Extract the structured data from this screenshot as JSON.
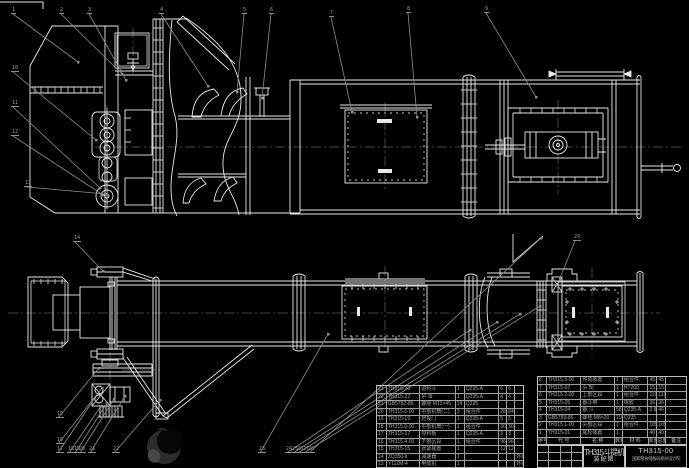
{
  "app": {
    "background": "#000000",
    "kind": "cad-assembly-drawing"
  },
  "colors": {
    "line": "#e9e9e9",
    "thin_line": "#c9c9c9",
    "leader": "#8d8d8d",
    "centerline": "#585858",
    "table_line": "#9f9f9f",
    "table_text": "#a9a9a9",
    "logo_body": "#2c2c2c",
    "logo_hole": "#060606",
    "logo_glow": "#474747"
  },
  "title_block": {
    "product": "TH315斗提机",
    "sheet": "装配图",
    "drawing_no": "TH315-00",
    "company": "国家粮食储备局郑州设计院"
  },
  "bom": {
    "header": [
      "序号",
      "代 号",
      "名 称",
      "数量",
      "材 料",
      "单重",
      "总重",
      "备注"
    ],
    "left_rows": [
      [
        "23",
        "TH315-23",
        "进料斗",
        "1",
        "Q235-A",
        "6",
        "6",
        ""
      ],
      [
        "22",
        "TH315-22",
        "护 罩",
        "1",
        "Q235-A",
        "4",
        "4",
        ""
      ],
      [
        "21",
        "GB5782-86",
        "螺栓 M12×45",
        "24",
        "Q235",
        "",
        "",
        ""
      ],
      [
        "20",
        "TH315.6-00",
        "中部机筒(二)",
        "3",
        "组合件",
        "28",
        "84",
        ""
      ],
      [
        "19",
        "TH315-19",
        "检视门",
        "1",
        "Q235-A",
        "5",
        "5",
        ""
      ],
      [
        "18",
        "TH315.5-00",
        "中部机筒(一)",
        "1",
        "组合件",
        "30",
        "30",
        ""
      ],
      [
        "17",
        "TH315-17",
        "导料板",
        "1",
        "Q235-A",
        "3",
        "3",
        ""
      ],
      [
        "16",
        "TH315.4-00",
        "下部区段",
        "1",
        "组合件",
        "96",
        "96",
        ""
      ],
      [
        "15",
        "TH315-15",
        "张紧装置",
        "1",
        "",
        "12",
        "12",
        ""
      ],
      [
        "14",
        "ZQ350-Ⅱ",
        "减速器",
        "1",
        "",
        "",
        "",
        "外购"
      ],
      [
        "13",
        "Y112M-4",
        "电动机",
        "1",
        "",
        "",
        "",
        "外购"
      ]
    ],
    "right_rows": [
      [
        "8",
        "TH315.3-00",
        "传动装置",
        "1",
        "组合件",
        "45",
        "45",
        ""
      ],
      [
        "7",
        "TH315-07",
        "头 轮",
        "1",
        "HT200",
        "15",
        "15",
        ""
      ],
      [
        "6",
        "TH315.2-00",
        "上部区段",
        "1",
        "组合件",
        "110",
        "110",
        ""
      ],
      [
        "5",
        "TH315-05",
        "畚斗带",
        "1",
        "橡胶",
        "36",
        "36",
        ""
      ],
      [
        "4",
        "TH315-04",
        "畚 斗",
        "58",
        "Q235-A",
        "0.8",
        "46",
        ""
      ],
      [
        "3",
        "GB5783-86",
        "螺栓 M8×20",
        "116",
        "Q235",
        "",
        "",
        ""
      ],
      [
        "2",
        "TH315.1-00",
        "头部区段",
        "1",
        "组合件",
        "105",
        "105",
        ""
      ],
      [
        "1",
        "TH315-01",
        "尾轮装置",
        "1",
        "",
        "40",
        "40",
        ""
      ]
    ]
  },
  "balloons": [
    {
      "n": "1",
      "x": 11,
      "y": 8,
      "tx": 78,
      "ty": 62
    },
    {
      "n": "2",
      "x": 59,
      "y": 8,
      "tx": 122,
      "ty": 74
    },
    {
      "n": "3",
      "x": 87,
      "y": 8,
      "tx": 126,
      "ty": 80
    },
    {
      "n": "4",
      "x": 159,
      "y": 8,
      "tx": 208,
      "ty": 86
    },
    {
      "n": "5",
      "x": 242,
      "y": 8,
      "tx": 237,
      "ty": 92
    },
    {
      "n": "6",
      "x": 269,
      "y": 8,
      "tx": 262,
      "ty": 98
    },
    {
      "n": "7",
      "x": 329,
      "y": 11,
      "tx": 352,
      "ty": 112
    },
    {
      "n": "8",
      "x": 406,
      "y": 7,
      "tx": 417,
      "ty": 117
    },
    {
      "n": "9",
      "x": 484,
      "y": 7,
      "tx": 536,
      "ty": 97
    },
    {
      "n": "10",
      "x": 11,
      "y": 66,
      "tx": 96,
      "ty": 140
    },
    {
      "n": "11",
      "x": 11,
      "y": 101,
      "tx": 100,
      "ty": 188
    },
    {
      "n": "12",
      "x": 11,
      "y": 130,
      "tx": 103,
      "ty": 195
    },
    {
      "n": "13",
      "x": 24,
      "y": 181,
      "tx": 106,
      "ty": 194
    },
    {
      "n": "14",
      "x": 73,
      "y": 236,
      "tx": 103,
      "ty": 271
    },
    {
      "n": "15",
      "x": 56,
      "y": 412,
      "tx": 99,
      "ty": 368
    },
    {
      "n": "16",
      "x": 56,
      "y": 438,
      "tx": 102,
      "ty": 388
    },
    {
      "n": "17",
      "x": 56,
      "y": 447,
      "tx": 94,
      "ty": 399
    },
    {
      "n": "18",
      "x": 67,
      "y": 447,
      "tx": 101,
      "ty": 406
    },
    {
      "n": "19",
      "x": 73,
      "y": 447,
      "tx": 107,
      "ty": 403
    },
    {
      "n": "20",
      "x": 78,
      "y": 447,
      "tx": 114,
      "ty": 399
    },
    {
      "n": "21",
      "x": 88,
      "y": 447,
      "tx": 125,
      "ty": 396
    },
    {
      "n": "22",
      "x": 112,
      "y": 447,
      "tx": 160,
      "ty": 400
    },
    {
      "n": "23",
      "x": 258,
      "y": 447,
      "tx": 328,
      "ty": 334
    },
    {
      "n": "24",
      "x": 285,
      "y": 447,
      "tx": 470,
      "ty": 330
    },
    {
      "n": "25",
      "x": 291,
      "y": 447,
      "tx": 497,
      "ty": 322
    },
    {
      "n": "26",
      "x": 296,
      "y": 447,
      "tx": 520,
      "ty": 314
    },
    {
      "n": "27",
      "x": 302,
      "y": 447,
      "tx": 540,
      "ty": 306
    },
    {
      "n": "28",
      "x": 307,
      "y": 447,
      "tx": 541,
      "ty": 238
    },
    {
      "n": "29",
      "x": 573,
      "y": 235,
      "tx": 560,
      "ty": 278
    }
  ]
}
